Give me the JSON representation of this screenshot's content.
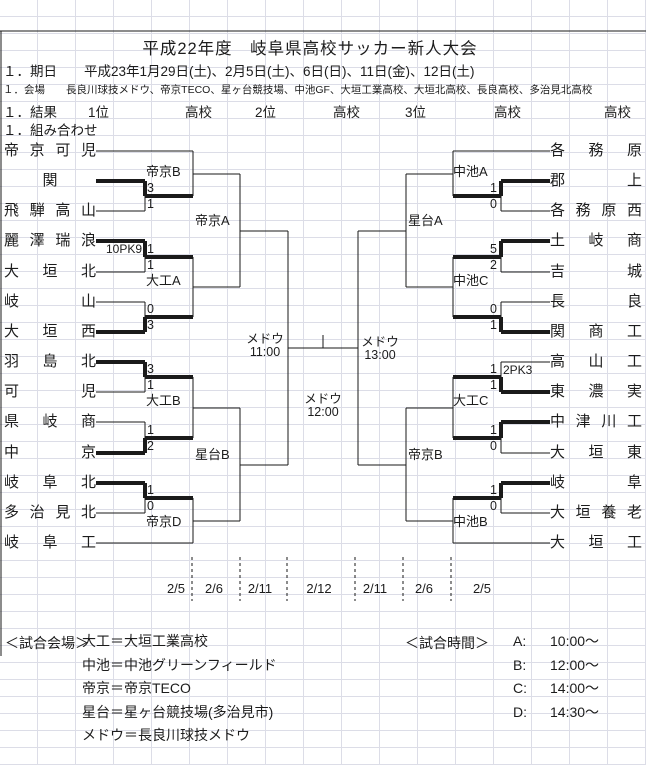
{
  "header": {
    "title": "平成22年度　岐阜県高校サッカー新人大会",
    "schedule": "１．期日　　平成23年1月29日(土)、2月5日(土)、6日(日)、11日(金)、12日(土)",
    "venues": "１．会場　　長良川球技メドウ、帝京TECO、星ヶ台競技場、中池GF、大垣工業高校、大垣北高校、長良高校、多治見北高校",
    "result_label": "１．結果",
    "result_items": [
      "1位",
      "高校",
      "2位",
      "高校",
      "3位",
      "高校",
      "高校"
    ],
    "pairing_label": "１．組み合わせ"
  },
  "bracket": {
    "left_teams": [
      "帝京可児",
      "関",
      "飛騨高山",
      "麗澤瑞浪",
      "大垣北",
      "岐山",
      "大垣西",
      "羽島北",
      "可児",
      "県岐商",
      "中京",
      "岐阜北",
      "多治見北",
      "岐阜工"
    ],
    "right_teams": [
      "各務原",
      "郡上",
      "各務原西",
      "土岐商",
      "吉城",
      "長良",
      "関商工",
      "高山工",
      "東濃実",
      "中津川工",
      "大垣東",
      "岐阜",
      "大垣養老",
      "大垣工"
    ],
    "left_r1": [
      {
        "venue": "帝京B",
        "venue_pos": "above",
        "scores": [
          "3",
          "1"
        ],
        "winner": "top",
        "pk": null
      },
      {
        "venue": "大工A",
        "venue_pos": "below",
        "scores": [
          "1",
          "1"
        ],
        "winner": "top",
        "pk": "10PK9"
      },
      {
        "venue": null,
        "venue_pos": null,
        "scores": [
          "0",
          "3"
        ],
        "winner": "bottom",
        "pk": null
      },
      {
        "venue": "大工B",
        "venue_pos": "below",
        "scores": [
          "3",
          "1"
        ],
        "winner": "top",
        "pk": null
      },
      {
        "venue": null,
        "venue_pos": null,
        "scores": [
          "1",
          "2"
        ],
        "winner": "bottom",
        "pk": null
      },
      {
        "venue": "帝京D",
        "venue_pos": "below",
        "scores": [
          "1",
          "0"
        ],
        "winner": "top",
        "pk": null
      }
    ],
    "right_r1": [
      {
        "venue": "中池A",
        "venue_pos": "above",
        "scores": [
          "1",
          "0"
        ],
        "winner": "top",
        "pk": null
      },
      {
        "venue": "中池C",
        "venue_pos": "below",
        "scores": [
          "5",
          "2"
        ],
        "winner": "top",
        "pk": null
      },
      {
        "venue": null,
        "venue_pos": null,
        "scores": [
          "0",
          "1"
        ],
        "winner": "bottom",
        "pk": null
      },
      {
        "venue": "大工C",
        "venue_pos": "below",
        "scores": [
          "1",
          "1"
        ],
        "winner": "bottom",
        "pk": "2PK3"
      },
      {
        "venue": null,
        "venue_pos": null,
        "scores": [
          "1",
          "0"
        ],
        "winner": "top",
        "pk": null
      },
      {
        "venue": "中池B",
        "venue_pos": "below",
        "scores": [
          "1",
          "0"
        ],
        "winner": "top",
        "pk": null
      }
    ],
    "left_r3_labels": [
      "帝京A",
      "星台B"
    ],
    "right_r3_labels": [
      "星台A",
      "帝京B"
    ],
    "semi_left": {
      "venue": "メドウ",
      "time": "11:00"
    },
    "semi_right": {
      "venue": "メドウ",
      "time": "13:00"
    },
    "final": {
      "venue": "メドウ",
      "time": "12:00"
    },
    "dates": [
      "2/5",
      "2/6",
      "2/11",
      "2/12",
      "2/11",
      "2/6",
      "2/5"
    ]
  },
  "legend": {
    "venues_label": "＜試合会場＞",
    "venues": [
      {
        "code": "大工",
        "name": "大垣工業高校"
      },
      {
        "code": "中池",
        "name": "中池グリーンフィールド"
      },
      {
        "code": "帝京",
        "name": "帝京TECO"
      },
      {
        "code": "星台",
        "name": "星ヶ台競技場(多治見市)"
      },
      {
        "code": "メドウ",
        "name": "長良川球技メドウ"
      }
    ],
    "times_label": "＜試合時間＞",
    "times": [
      {
        "slot": "A",
        "time": "10:00～"
      },
      {
        "slot": "B",
        "time": "12:00～"
      },
      {
        "slot": "C",
        "time": "14:00～"
      },
      {
        "slot": "D",
        "time": "14:30～"
      }
    ]
  }
}
